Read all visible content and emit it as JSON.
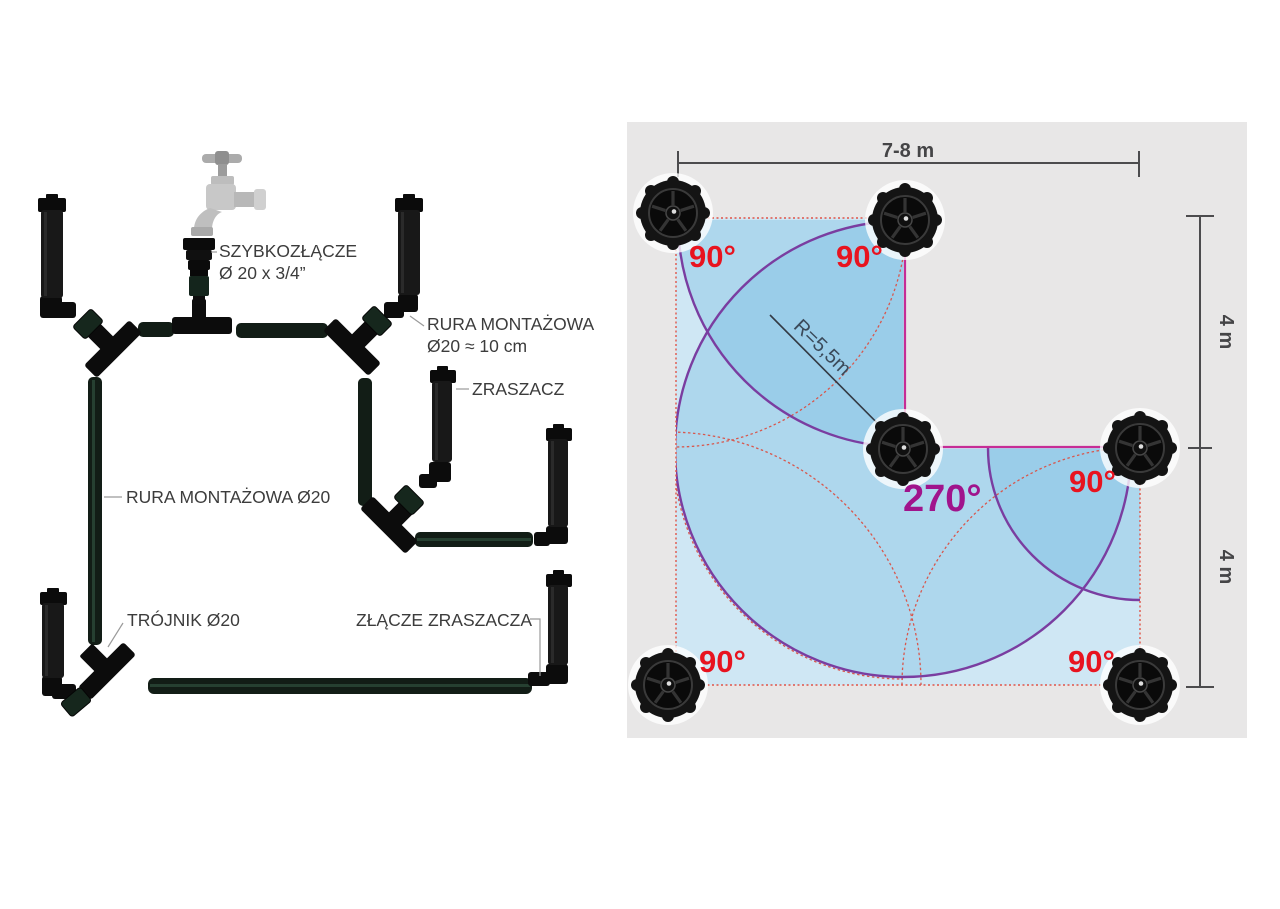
{
  "left_panel": {
    "labels": {
      "quick_connector_line1": "SZYBKOZŁĄCZE",
      "quick_connector_line2": "Ø 20 x 3/4”",
      "mounting_pipe_short_line1": "RURA MONTAŻOWA",
      "mounting_pipe_short_line2": "Ø20 ≈ 10 cm",
      "sprinkler": "ZRASZACZ",
      "mounting_pipe": "RURA MONTAŻOWA Ø20",
      "tee": "TRÓJNIK Ø20",
      "sprinkler_connector": "ZŁĄCZE ZRASZACZA"
    }
  },
  "right_panel": {
    "dimensions": {
      "width": "7-8 m",
      "height_upper": "4 m",
      "height_lower": "4 m"
    },
    "radius_label": "R=5,5m",
    "angle_labels": {
      "top_left": "90°",
      "top_middle": "90°",
      "center": "270°",
      "middle_right": "90°",
      "bottom_left": "90°",
      "bottom_right": "90°"
    },
    "colors": {
      "angle_90": "#e8131f",
      "angle_270": "#a0148c",
      "lawn": "#cfe7f4",
      "panel_background": "#e8e7e7",
      "coverage_arc_purple": "#7a3da0",
      "coverage_arc_red": "#d8574d",
      "boundary_magenta": "#c62d96",
      "dimension_gray": "#4c4c4e"
    }
  }
}
